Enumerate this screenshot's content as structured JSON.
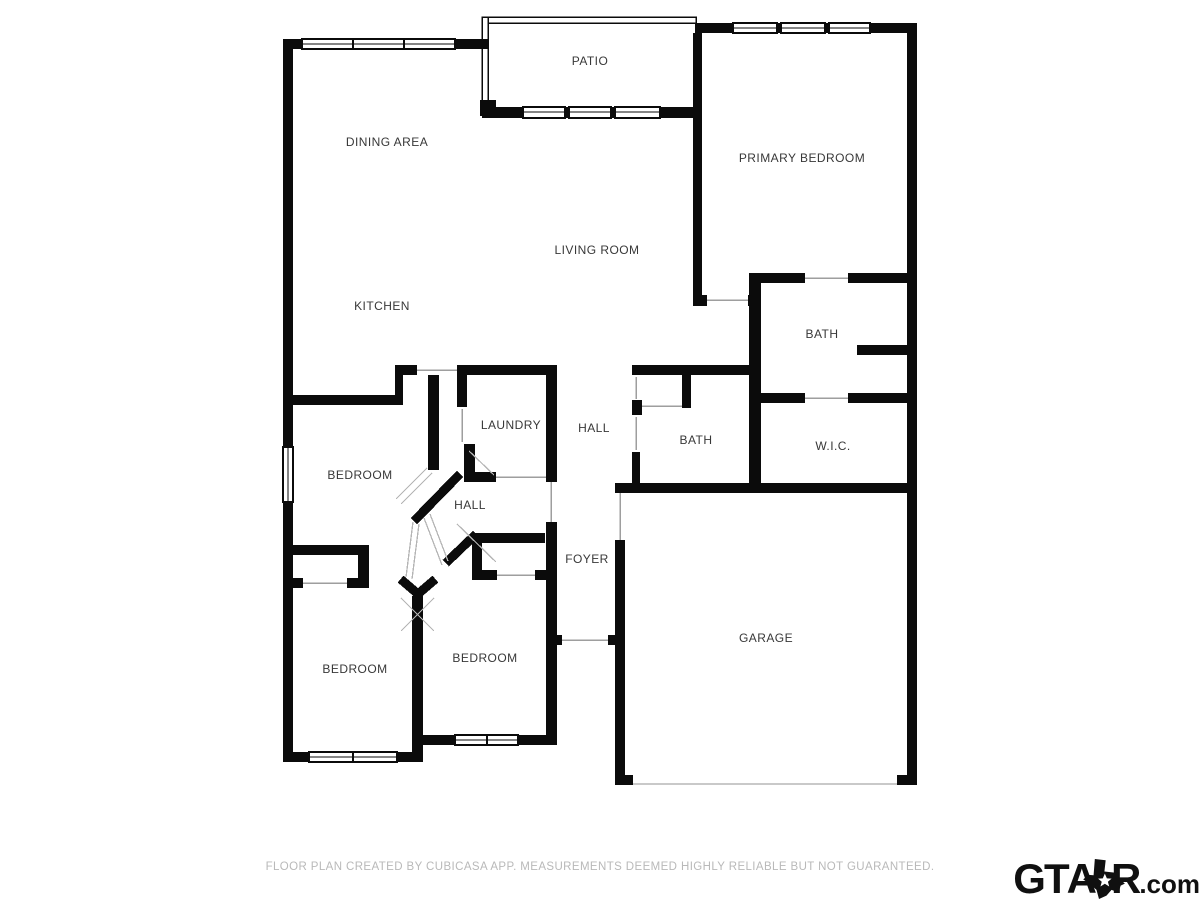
{
  "colors": {
    "bg": "#ffffff",
    "wall": "#0b0b0b",
    "opening": "#9e9e9e",
    "swing": "#b5b5b5",
    "garage-line": "#c9c9c9",
    "label": "#383838",
    "footer": "#b9b9b9",
    "logo": "#101010"
  },
  "rooms": [
    {
      "label": "PATIO",
      "x": 590,
      "y": 61
    },
    {
      "label": "DINING AREA",
      "x": 387,
      "y": 142
    },
    {
      "label": "PRIMARY BEDROOM",
      "x": 802,
      "y": 158
    },
    {
      "label": "LIVING ROOM",
      "x": 597,
      "y": 250
    },
    {
      "label": "KITCHEN",
      "x": 382,
      "y": 306
    },
    {
      "label": "BATH",
      "x": 822,
      "y": 334
    },
    {
      "label": "LAUNDRY",
      "x": 511,
      "y": 425
    },
    {
      "label": "HALL",
      "x": 594,
      "y": 428
    },
    {
      "label": "BATH",
      "x": 696,
      "y": 440
    },
    {
      "label": "W.I.C.",
      "x": 833,
      "y": 446
    },
    {
      "label": "BEDROOM",
      "x": 360,
      "y": 475
    },
    {
      "label": "HALL",
      "x": 470,
      "y": 505
    },
    {
      "label": "FOYER",
      "x": 587,
      "y": 559
    },
    {
      "label": "GARAGE",
      "x": 766,
      "y": 638
    },
    {
      "label": "BEDROOM",
      "x": 355,
      "y": 669
    },
    {
      "label": "BEDROOM",
      "x": 485,
      "y": 658
    }
  ],
  "footer": {
    "disclaimer": "FLOOR PLAN CREATED BY CUBICASA APP. MEASUREMENTS DEEMED HIGHLY RELIABLE BUT NOT GUARANTEED."
  },
  "logo": {
    "gt": "GT",
    "a": "A",
    "r": "R",
    "tld": ".com"
  }
}
